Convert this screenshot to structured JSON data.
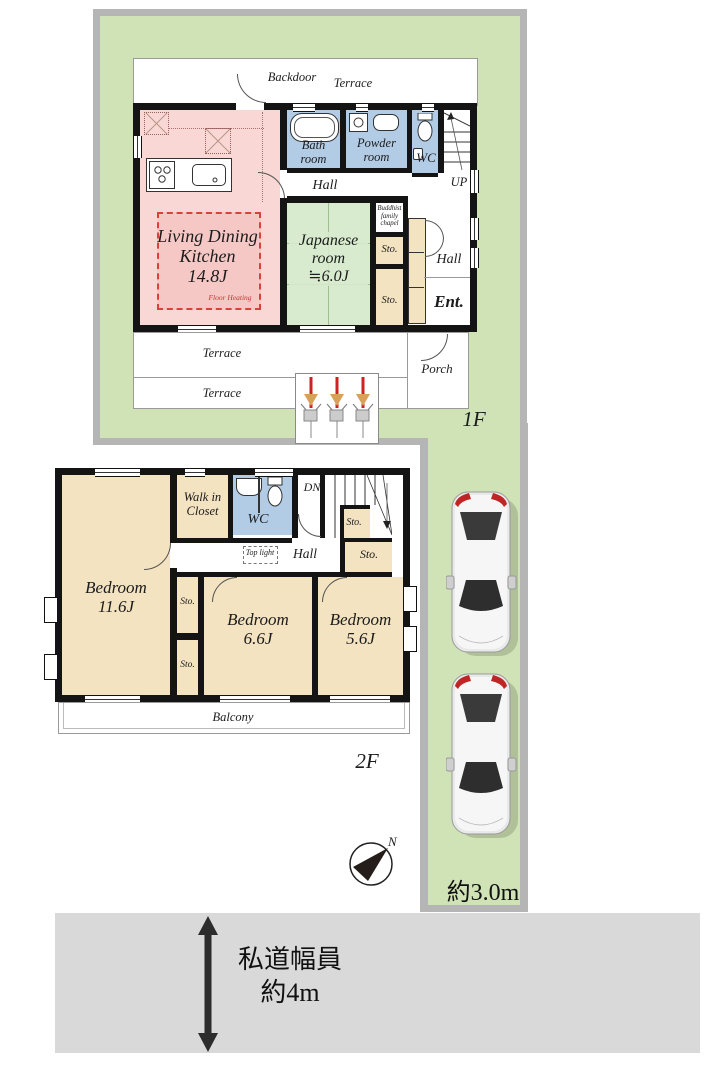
{
  "site": {
    "floor1_tag": "1F",
    "floor2_tag": "2F",
    "north_label": "N",
    "driveway_width": "約3.0m",
    "road_caption_line1": "私道幅員",
    "road_caption_line2": "約4m"
  },
  "colors": {
    "lot_green": "#cfe3b6",
    "border_gray": "#b5b5b5",
    "road_gray": "#d9d9d9",
    "wall_black": "#141414",
    "ldk_pink": "#f8d7d4",
    "floor_heating_pink": "#f5c8c5",
    "floor_heating_red": "#d8413c",
    "tatami_green": "#d8ebcf",
    "wet_area_blue": "#b3cce6",
    "closet_tan": "#f3e3c0"
  },
  "floor1": {
    "backdoor": "Backdoor",
    "terrace_top": "Terrace",
    "bath": "Bath room",
    "powder": "Powder room",
    "wc": "WC",
    "up": "UP",
    "hall_upper": "Hall",
    "ldk_name": "Living Dining Kitchen",
    "ldk_size": "14.8J",
    "floor_heating": "Floor Heating",
    "japanese_name": "Japanese room",
    "japanese_size": "≒6.0J",
    "chapel": "Buddhist family chapel",
    "sto": "Sto.",
    "hall_right": "Hall",
    "entrance": "Ent.",
    "terrace_mid": "Terrace",
    "terrace_low": "Terrace",
    "porch": "Porch"
  },
  "floor2": {
    "wic": "Walk in Closet",
    "wc": "WC",
    "dn": "DN",
    "sto": "Sto.",
    "top_light": "Top light",
    "hall": "Hall",
    "bedroom1_name": "Bedroom",
    "bedroom1_size": "11.6J",
    "bedroom2_name": "Bedroom",
    "bedroom2_size": "6.6J",
    "bedroom3_name": "Bedroom",
    "bedroom3_size": "5.6J",
    "balcony": "Balcony"
  }
}
